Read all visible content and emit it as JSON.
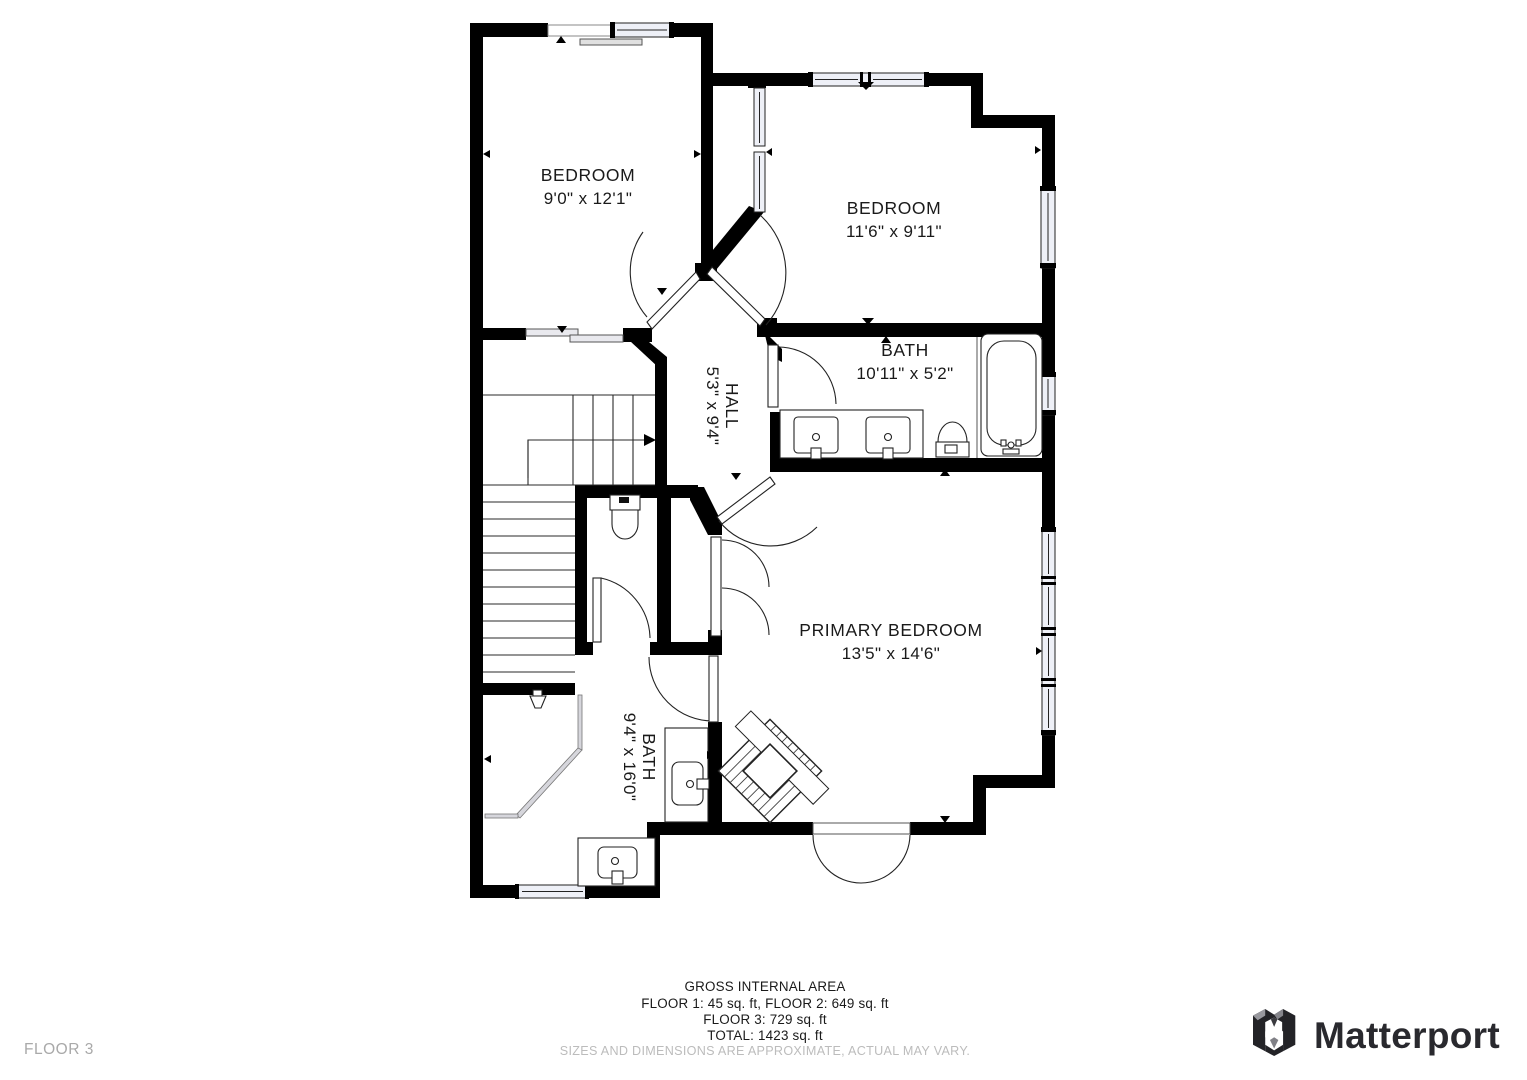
{
  "floor_label": "FLOOR 3",
  "rooms": {
    "bedroom1": {
      "name": "BEDROOM",
      "dims": "9'0\" x 12'1\""
    },
    "bedroom2": {
      "name": "BEDROOM",
      "dims": "11'6\" x 9'11\""
    },
    "hall": {
      "name": "HALL",
      "dims": "5'3\" x 9'4\""
    },
    "bath1": {
      "name": "BATH",
      "dims": "10'11\" x 5'2\""
    },
    "primary": {
      "name": "PRIMARY BEDROOM",
      "dims": "13'5\" x 14'6\""
    },
    "bath2": {
      "name": "BATH",
      "dims": "9'4\" x 16'0\""
    }
  },
  "footer": {
    "title": "GROSS INTERNAL AREA",
    "line1": "FLOOR 1: 45 sq. ft, FLOOR 2: 649 sq. ft",
    "line2": "FLOOR 3: 729 sq. ft",
    "line3": "TOTAL: 1423 sq. ft",
    "disclaimer": "SIZES AND DIMENSIONS ARE APPROXIMATE, ACTUAL MAY VARY."
  },
  "brand": {
    "name": "Matterport"
  },
  "colors": {
    "wall": "#000000",
    "glass": "#eef0f7",
    "brand_dark": "#29292e",
    "muted": "#a9a9a9"
  }
}
